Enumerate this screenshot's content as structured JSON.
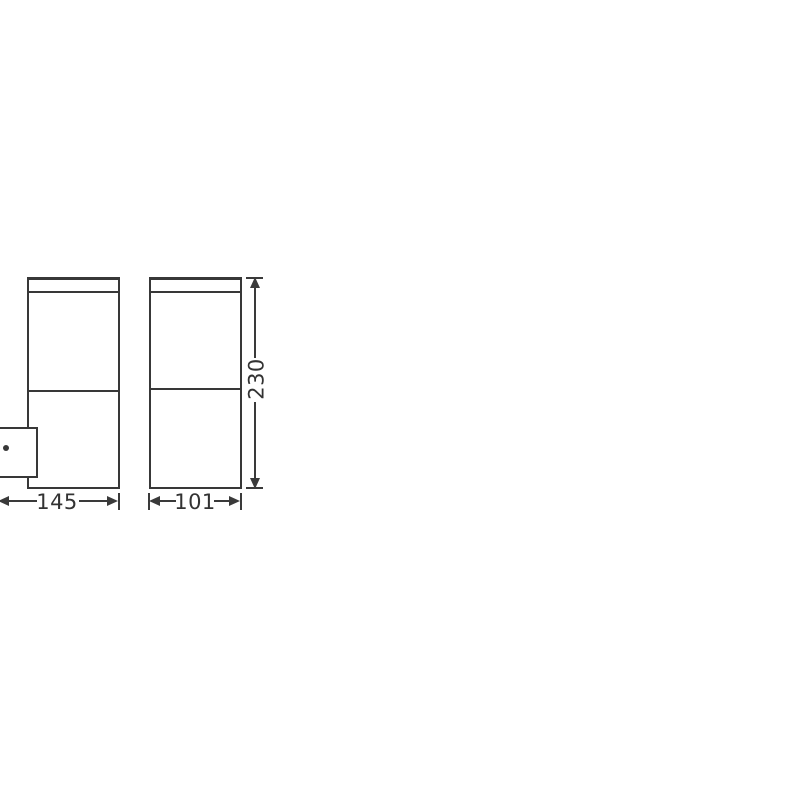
{
  "drawing": {
    "kind": "product-dimension-diagram",
    "subject": "wall-mounted outdoor luminaire, two orthographic views",
    "background_color": "#ffffff",
    "line_color": "#383838",
    "text_color": "#333333"
  },
  "dimensions": {
    "depth_with_bracket": {
      "value": "145"
    },
    "body_width": {
      "value": "101"
    },
    "body_height": {
      "value": "230"
    }
  }
}
